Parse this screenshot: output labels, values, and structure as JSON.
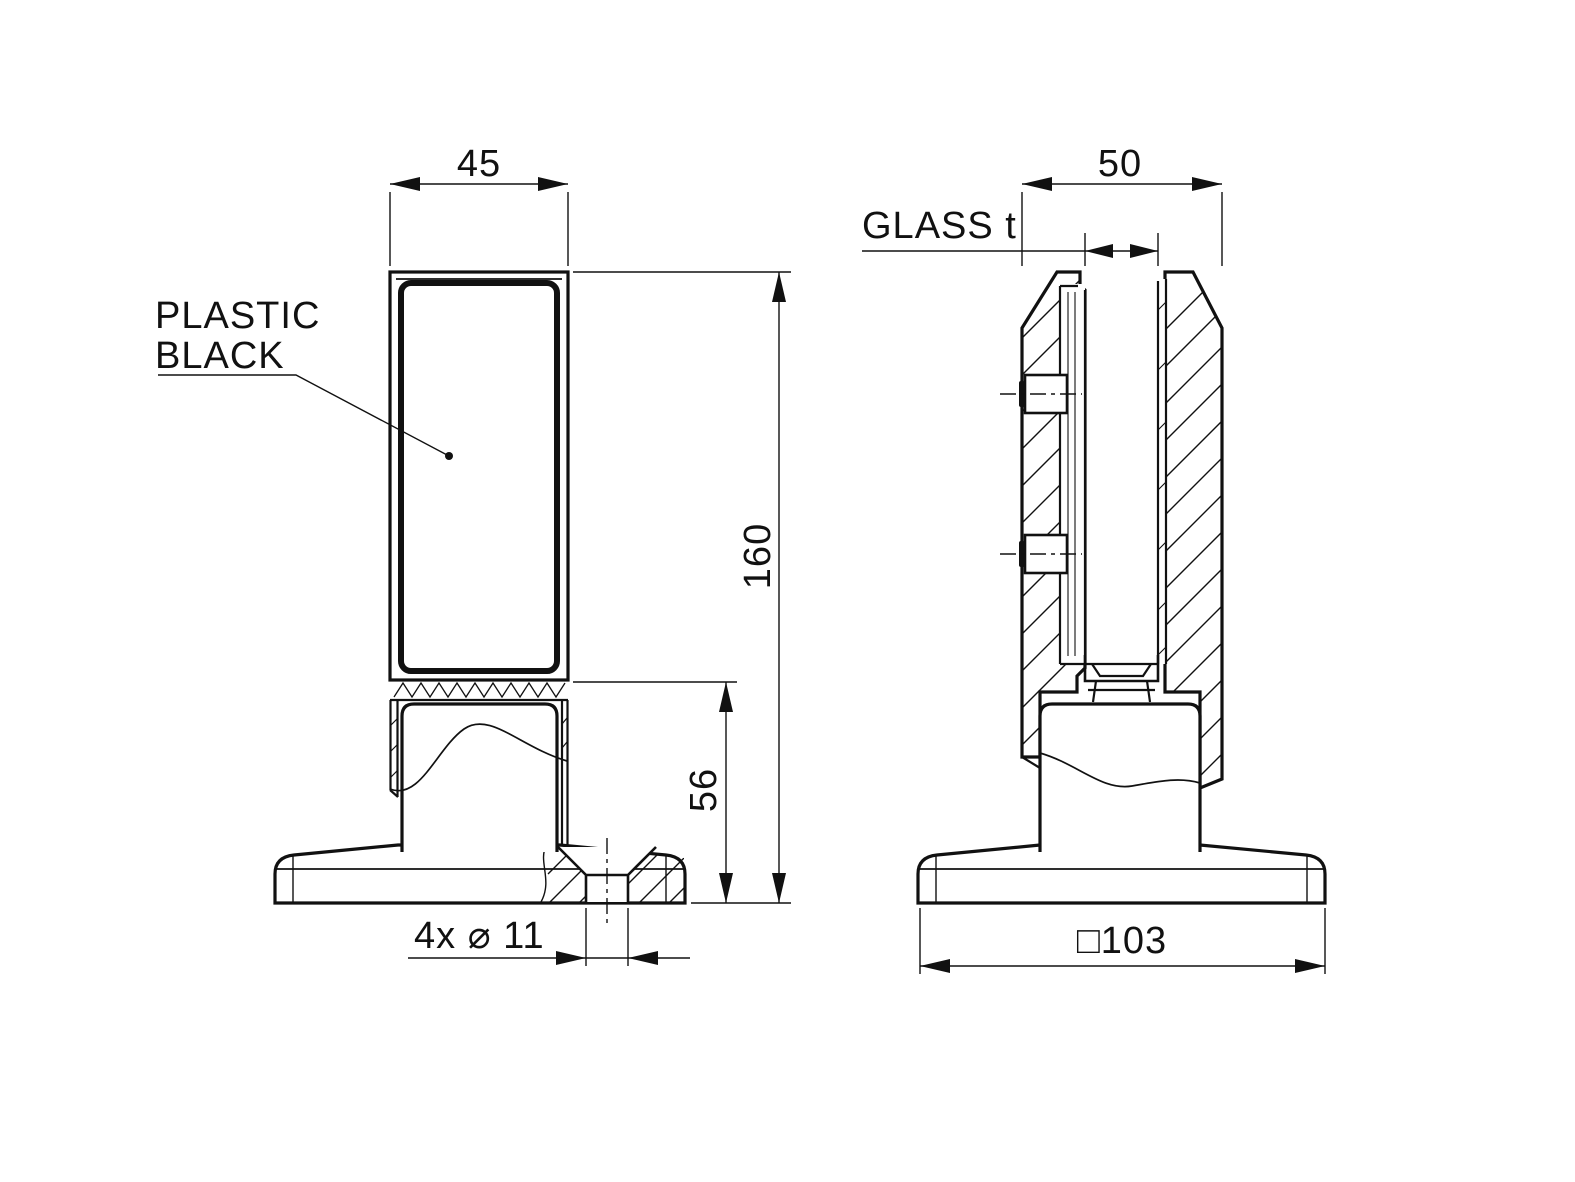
{
  "drawing": {
    "background": "#ffffff",
    "line_color": "#111111",
    "views": {
      "front": {
        "label_note": {
          "line1": "PLASTIC",
          "line2": "BLACK"
        },
        "dim_width": "45",
        "dim_height": "160",
        "dim_base_height": "56",
        "dim_holes": "4x ⌀ 11"
      },
      "side": {
        "dim_depth": "50",
        "dim_glass": "GLASS t",
        "dim_base_width": "□103"
      }
    }
  }
}
